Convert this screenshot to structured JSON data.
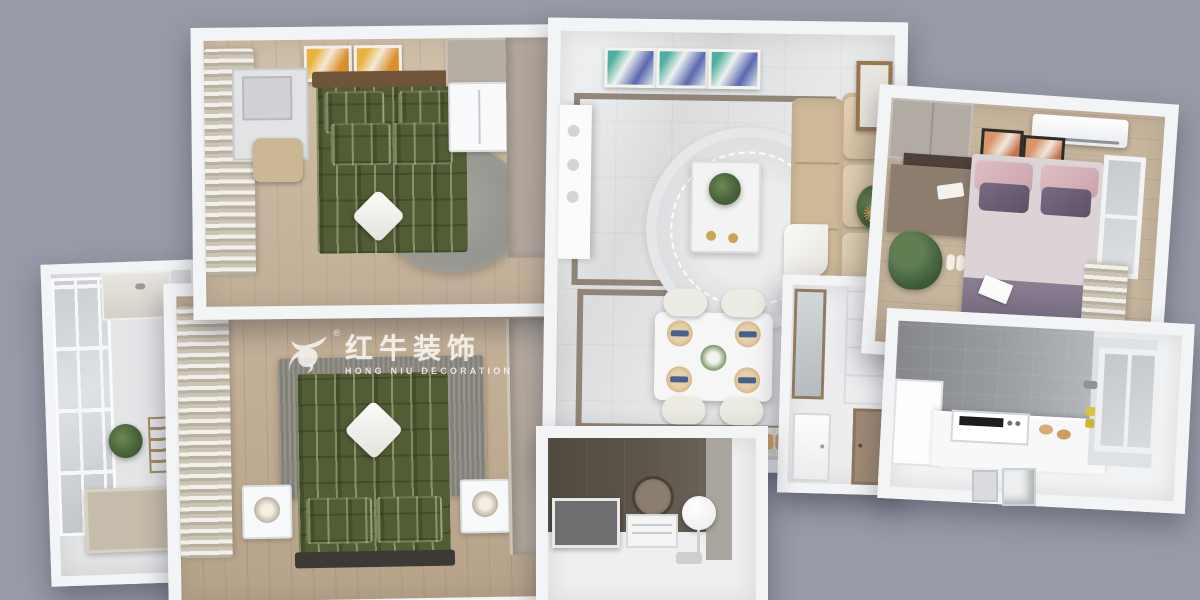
{
  "scene": {
    "description": "3D isometric cutaway floor-plan render of a two-bedroom apartment",
    "background_color": "#979ba7",
    "wall_color": "#f3f4f6",
    "rooms": [
      {
        "name": "balcony"
      },
      {
        "name": "master-bedroom"
      },
      {
        "name": "second-bedroom"
      },
      {
        "name": "living-room"
      },
      {
        "name": "dining-area"
      },
      {
        "name": "entry-hall"
      },
      {
        "name": "third-bedroom"
      },
      {
        "name": "kitchen"
      },
      {
        "name": "bathroom"
      }
    ],
    "palette": {
      "wood_floor": "#c7b59d",
      "marble_floor": "#dadcde",
      "green_plaid_bed": "#525c35",
      "beige_sofa": "#cdb897",
      "pink_pillow": "#d6b2b9",
      "purple_blanket": "#6e6279",
      "kitchen_tile": "#9a9da1",
      "bathroom_wall": "#5d554a",
      "gold_accent": "#c9a653"
    }
  },
  "watermark": {
    "icon": "bull-logo-icon",
    "registered": "®",
    "brand_cn": "红牛装饰",
    "brand_en": "HONG NIU DECORATION",
    "color": "#f7f6f2"
  },
  "clock_glyph": "✺"
}
